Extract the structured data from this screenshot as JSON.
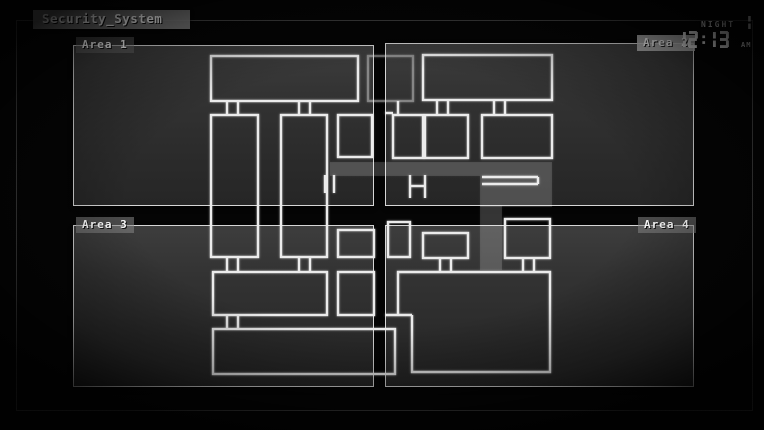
{
  "title_bar": {
    "title": "Security_System"
  },
  "hud": {
    "night_label": "NIGHT",
    "night_number": "1",
    "time": "12:13",
    "meridiem": "AM"
  },
  "panels": [
    {
      "id": "area-1",
      "label": "Area 1",
      "label_side": "left"
    },
    {
      "id": "area-2",
      "label": "Area 2",
      "label_side": "right"
    },
    {
      "id": "area-3",
      "label": "Area 3",
      "label_side": "left"
    },
    {
      "id": "area-4",
      "label": "Area 4",
      "label_side": "right"
    }
  ],
  "colors": {
    "background": "#050505",
    "panel_border": "#d6d6d6",
    "map_line": "#ebebeb",
    "outer_frame": "#3f3f3f",
    "label_chip": "#8f8f8f",
    "text": "#f2f2f2"
  },
  "map": {
    "rooms": [
      [
        211,
        56,
        147,
        45
      ],
      [
        423,
        55,
        129,
        45
      ],
      [
        211,
        115,
        47,
        142
      ],
      [
        281,
        115,
        46,
        142
      ],
      [
        338,
        115,
        34,
        42
      ],
      [
        393,
        115,
        30,
        43
      ],
      [
        425,
        115,
        43,
        43
      ],
      [
        482,
        115,
        70,
        43
      ],
      [
        423,
        233,
        45,
        25
      ],
      [
        505,
        219,
        45,
        39
      ],
      [
        388,
        222,
        22,
        35
      ],
      [
        338,
        230,
        36,
        27
      ],
      [
        213,
        272,
        114,
        43
      ],
      [
        338,
        272,
        36,
        43
      ],
      [
        213,
        329,
        182,
        45
      ]
    ],
    "ghost_rooms": [
      [
        368,
        56,
        45,
        45
      ]
    ],
    "vlines": [
      [
        227,
        101,
        115
      ],
      [
        238,
        101,
        115
      ],
      [
        299,
        101,
        115
      ],
      [
        310,
        101,
        115
      ],
      [
        437,
        100,
        115
      ],
      [
        448,
        100,
        115
      ],
      [
        494,
        100,
        115
      ],
      [
        505,
        100,
        115
      ],
      [
        398,
        101,
        115
      ],
      [
        227,
        257,
        272
      ],
      [
        238,
        257,
        272
      ],
      [
        299,
        257,
        272
      ],
      [
        310,
        257,
        272
      ],
      [
        440,
        258,
        272
      ],
      [
        451,
        258,
        272
      ],
      [
        523,
        258,
        272
      ],
      [
        534,
        258,
        272
      ],
      [
        227,
        315,
        329
      ],
      [
        238,
        315,
        329
      ],
      [
        325,
        175,
        193
      ],
      [
        334,
        175,
        193
      ],
      [
        410,
        175,
        198
      ],
      [
        425,
        175,
        198
      ],
      [
        538,
        177,
        184
      ]
    ],
    "hlines": [
      [
        385,
        393,
        113
      ],
      [
        410,
        425,
        186
      ],
      [
        482,
        538,
        177
      ],
      [
        482,
        538,
        184
      ],
      [
        385,
        412,
        315
      ]
    ],
    "polylines": [
      [
        [
          398,
          315
        ],
        [
          398,
          272
        ],
        [
          550,
          272
        ],
        [
          550,
          372
        ],
        [
          412,
          372
        ],
        [
          412,
          315
        ]
      ]
    ],
    "watermark_rects": [
      [
        330,
        162,
        222,
        14
      ],
      [
        480,
        176,
        72,
        31
      ],
      [
        480,
        206,
        22,
        64
      ]
    ]
  }
}
